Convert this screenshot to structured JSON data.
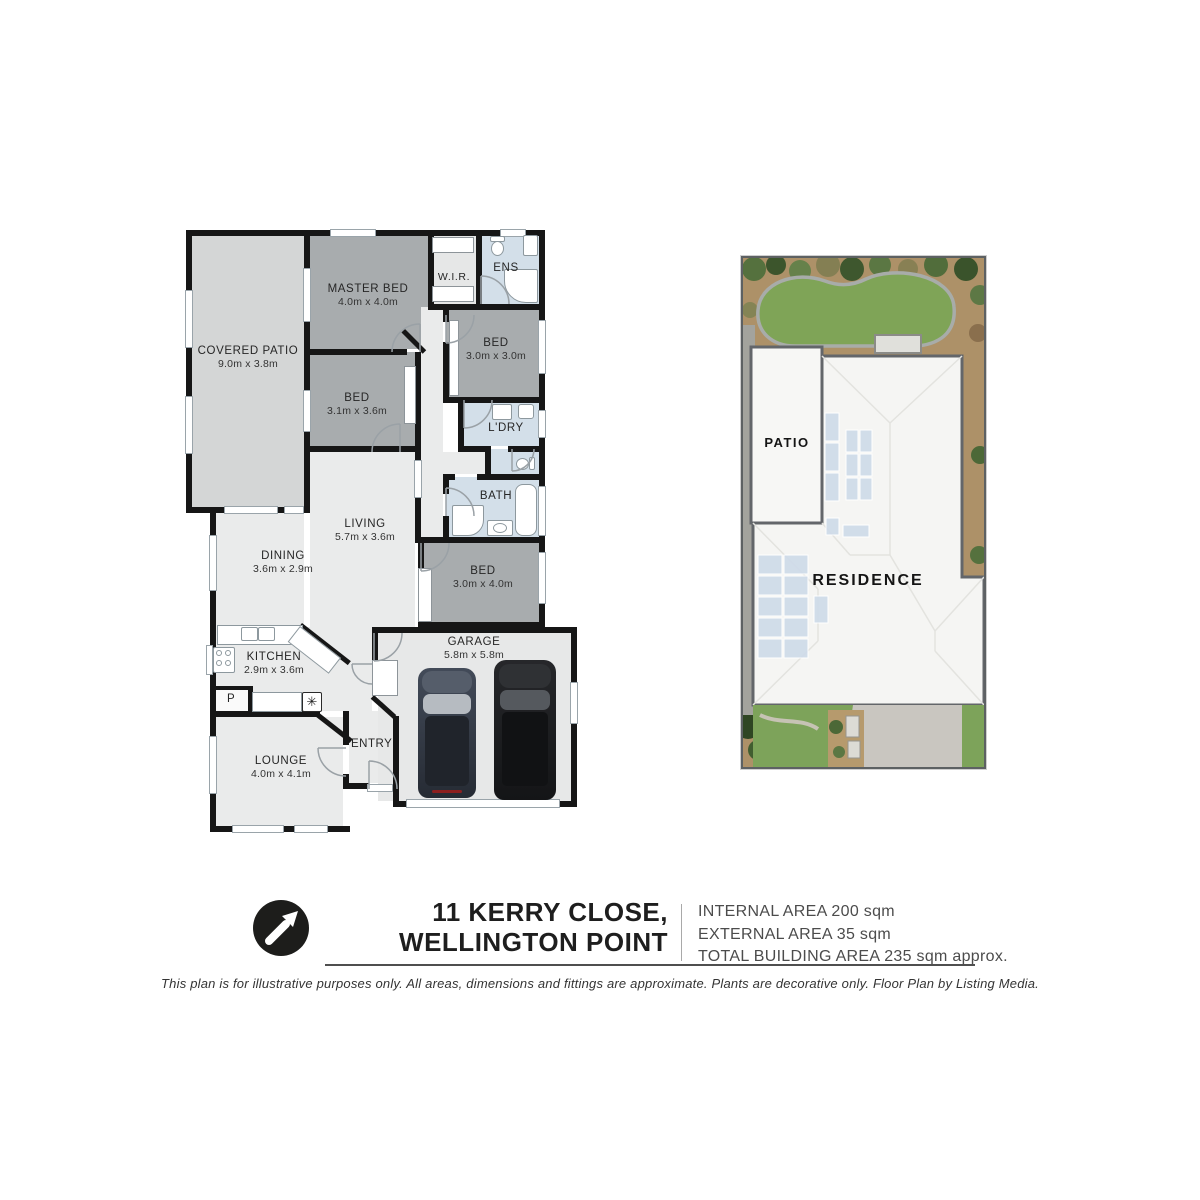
{
  "floor_plan": {
    "rooms": {
      "covered_patio": {
        "label": "COVERED PATIO",
        "dims": "9.0m x 3.8m"
      },
      "master_bed": {
        "label": "MASTER BED",
        "dims": "4.0m x 4.0m"
      },
      "wir": {
        "label": "W.I.R."
      },
      "ens": {
        "label": "ENS"
      },
      "bed_1": {
        "label": "BED",
        "dims": "3.0m x 3.0m"
      },
      "bed_2": {
        "label": "BED",
        "dims": "3.1m x 3.6m"
      },
      "ldry": {
        "label": "L'DRY"
      },
      "bath": {
        "label": "BATH"
      },
      "living": {
        "label": "LIVING",
        "dims": "5.7m x 3.6m"
      },
      "dining": {
        "label": "DINING",
        "dims": "3.6m x 2.9m"
      },
      "bed_3": {
        "label": "BED",
        "dims": "3.0m x 4.0m"
      },
      "garage": {
        "label": "GARAGE",
        "dims": "5.8m x 5.8m"
      },
      "kitchen": {
        "label": "KITCHEN",
        "dims": "2.9m x 3.6m"
      },
      "lounge": {
        "label": "LOUNGE",
        "dims": "4.0m x 4.1m"
      },
      "entry": {
        "label": "ENTRY"
      },
      "pantry": {
        "label": "P"
      }
    },
    "fridge_symbol": "✳",
    "colors": {
      "wall": "#161616",
      "bedroom_fill": "#a8acae",
      "patio_fill": "#d4d6d6",
      "living_fill": "#eaebeb",
      "garage_fill": "#e7e8e8",
      "wet_area_fill": "#d3dfe9"
    }
  },
  "site_plan": {
    "patio_label": "PATIO",
    "residence_label": "RESIDENCE",
    "colors": {
      "lawn": "#7fa457",
      "roof": "#f5f5f3",
      "solar_panel": "#cfdbe9",
      "driveway": "#c9c6c0",
      "garden_bed": "#ad9168"
    }
  },
  "footer": {
    "north_arrow": "northeast",
    "address_line1": "11 KERRY CLOSE,",
    "address_line2": "WELLINGTON POINT",
    "areas": {
      "internal": "INTERNAL AREA 200 sqm",
      "external": "EXTERNAL AREA 35 sqm",
      "total": "TOTAL BUILDING AREA 235 sqm approx."
    },
    "disclaimer": "This plan is for illustrative purposes only. All areas, dimensions and fittings are approximate. Plants are decorative only. Floor Plan by Listing Media."
  }
}
